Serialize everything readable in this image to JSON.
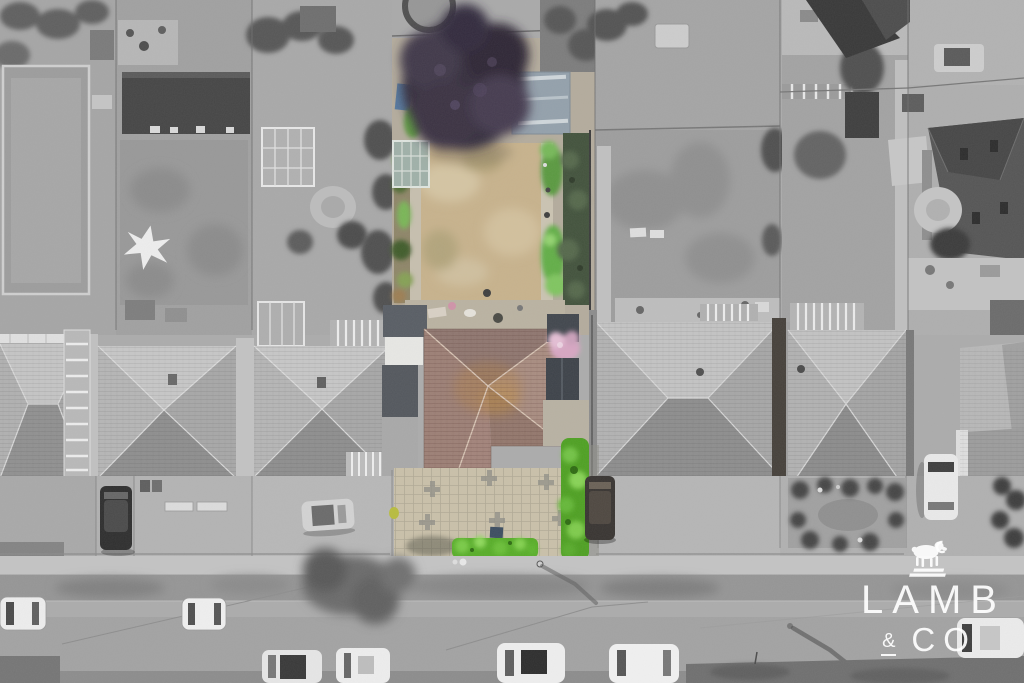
{
  "watermark": {
    "brand_line1": "LAMB",
    "brand_amp": "&",
    "brand_line2": "CO",
    "icon": "ram-icon",
    "color": "#ffffff"
  },
  "scene": {
    "type": "aerial-drone-photograph",
    "style": "selective colour — centre property shown in colour, surroundings greyscale"
  },
  "palette": {
    "subject_lawn": "#c7b28c",
    "subject_roof": "#9a8076",
    "front_hedge_green": "#57ad28",
    "copper_beech_tree": "#362e3c",
    "greyscale_base": "#ababab",
    "road": "#a2a2a2",
    "driveway_paving": "#c9c0a9"
  }
}
